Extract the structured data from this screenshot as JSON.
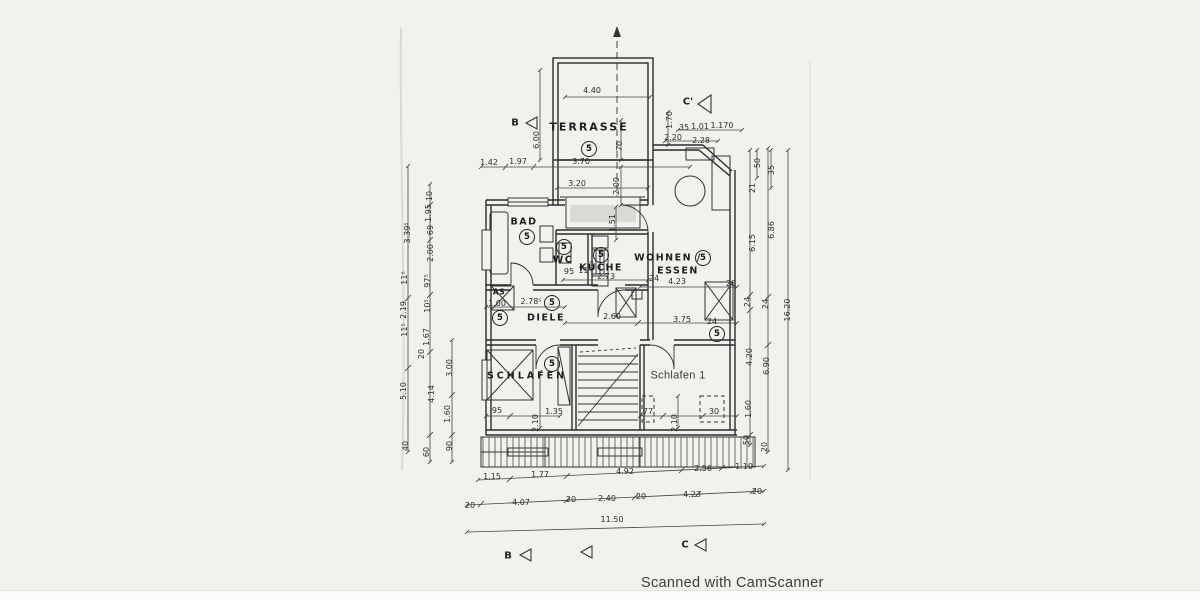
{
  "meta": {
    "watermark": "Scanned with CamScanner",
    "unit_number": "5"
  },
  "rooms": {
    "terrasse": "TERRASSE",
    "bad": "BAD",
    "wc": "WC",
    "kueche": "KÜCHE",
    "wohnen": "WOHNEN /",
    "essen": "ESSEN",
    "diele": "DIELE",
    "schlafen": "SCHLAFEN",
    "schlafen1": "Schlafen 1",
    "shaft": "AS"
  },
  "markers": {
    "b_top": "B",
    "c_prime_top": "C'",
    "b_bottom": "B",
    "c_bottom": "C"
  },
  "dim_labels": [
    {
      "t": "4.40",
      "x": 592,
      "y": 91,
      "r": 0
    },
    {
      "t": "6.00",
      "x": 537,
      "y": 140,
      "r": 1
    },
    {
      "t": "70",
      "x": 620,
      "y": 146,
      "r": 1
    },
    {
      "t": "3.70",
      "x": 581,
      "y": 162,
      "r": 0
    },
    {
      "t": "1.42",
      "x": 489,
      "y": 163,
      "r": 0
    },
    {
      "t": "1.97",
      "x": 518,
      "y": 162,
      "r": 0
    },
    {
      "t": "3.20",
      "x": 577,
      "y": 184,
      "r": 0
    },
    {
      "t": "2.00",
      "x": 617,
      "y": 186,
      "r": 1
    },
    {
      "t": "1.51",
      "x": 613,
      "y": 223,
      "r": 1
    },
    {
      "t": "1.70",
      "x": 670,
      "y": 120,
      "r": 1
    },
    {
      "t": "35",
      "x": 684,
      "y": 128,
      "r": 0
    },
    {
      "t": "1.01",
      "x": 700,
      "y": 127,
      "r": 0
    },
    {
      "t": "1.170",
      "x": 722,
      "y": 126,
      "r": 0
    },
    {
      "t": "2.20",
      "x": 673,
      "y": 138,
      "r": 0
    },
    {
      "t": "2.28",
      "x": 701,
      "y": 141,
      "r": 0
    },
    {
      "t": "50",
      "x": 758,
      "y": 163,
      "r": 1
    },
    {
      "t": "35",
      "x": 772,
      "y": 170,
      "r": 1
    },
    {
      "t": "21",
      "x": 753,
      "y": 188,
      "r": 1
    },
    {
      "t": "6.15",
      "x": 753,
      "y": 243,
      "r": 1
    },
    {
      "t": "6.86",
      "x": 772,
      "y": 230,
      "r": 1
    },
    {
      "t": "24",
      "x": 748,
      "y": 302,
      "r": 1
    },
    {
      "t": "24",
      "x": 766,
      "y": 304,
      "r": 1
    },
    {
      "t": "16.20",
      "x": 788,
      "y": 310,
      "r": 1
    },
    {
      "t": "4.20",
      "x": 750,
      "y": 357,
      "r": 1
    },
    {
      "t": "6.90",
      "x": 767,
      "y": 366,
      "r": 1
    },
    {
      "t": "1.60",
      "x": 749,
      "y": 409,
      "r": 1
    },
    {
      "t": "50",
      "x": 747,
      "y": 440,
      "r": 1
    },
    {
      "t": "20",
      "x": 765,
      "y": 447,
      "r": 1
    },
    {
      "t": "3.39⁵",
      "x": 408,
      "y": 233,
      "r": 1
    },
    {
      "t": "10",
      "x": 430,
      "y": 196,
      "r": 1
    },
    {
      "t": "1.95",
      "x": 429,
      "y": 213,
      "r": 1
    },
    {
      "t": "69",
      "x": 431,
      "y": 230,
      "r": 1
    },
    {
      "t": "2.00",
      "x": 431,
      "y": 253,
      "r": 1
    },
    {
      "t": "11⁵",
      "x": 405,
      "y": 278,
      "r": 1
    },
    {
      "t": "97⁵",
      "x": 428,
      "y": 281,
      "r": 1
    },
    {
      "t": "2.19",
      "x": 404,
      "y": 310,
      "r": 1
    },
    {
      "t": "10⁵",
      "x": 428,
      "y": 306,
      "r": 1
    },
    {
      "t": "11⁵",
      "x": 405,
      "y": 330,
      "r": 1
    },
    {
      "t": "1.67",
      "x": 427,
      "y": 337,
      "r": 1
    },
    {
      "t": "20",
      "x": 422,
      "y": 354,
      "r": 1
    },
    {
      "t": "3.00",
      "x": 450,
      "y": 368,
      "r": 1
    },
    {
      "t": "5.10",
      "x": 404,
      "y": 391,
      "r": 1
    },
    {
      "t": "4.14",
      "x": 432,
      "y": 394,
      "r": 1
    },
    {
      "t": "1.60",
      "x": 448,
      "y": 414,
      "r": 1
    },
    {
      "t": "40",
      "x": 406,
      "y": 446,
      "r": 1
    },
    {
      "t": "60",
      "x": 427,
      "y": 452,
      "r": 1
    },
    {
      "t": "90",
      "x": 450,
      "y": 446,
      "r": 1
    },
    {
      "t": "95",
      "x": 569,
      "y": 272,
      "r": 0
    },
    {
      "t": "11⁵",
      "x": 585,
      "y": 271,
      "r": 0
    },
    {
      "t": "2.73",
      "x": 606,
      "y": 277,
      "r": 0
    },
    {
      "t": "24",
      "x": 654,
      "y": 279,
      "r": 0
    },
    {
      "t": "4.23",
      "x": 677,
      "y": 282,
      "r": 0
    },
    {
      "t": "20",
      "x": 731,
      "y": 284,
      "r": 0
    },
    {
      "t": "1.00",
      "x": 497,
      "y": 304,
      "r": 0
    },
    {
      "t": "2.78⁵",
      "x": 531,
      "y": 302,
      "r": 0
    },
    {
      "t": "2.60",
      "x": 612,
      "y": 317,
      "r": 0
    },
    {
      "t": "3.75",
      "x": 682,
      "y": 320,
      "r": 0
    },
    {
      "t": "24",
      "x": 712,
      "y": 322,
      "r": 0
    },
    {
      "t": "95",
      "x": 497,
      "y": 411,
      "r": 0
    },
    {
      "t": "1.35",
      "x": 554,
      "y": 412,
      "r": 0
    },
    {
      "t": "2.10",
      "x": 536,
      "y": 423,
      "r": 1
    },
    {
      "t": "77",
      "x": 648,
      "y": 412,
      "r": 0
    },
    {
      "t": "30",
      "x": 714,
      "y": 412,
      "r": 0
    },
    {
      "t": "2.10",
      "x": 675,
      "y": 423,
      "r": 1
    },
    {
      "t": "1.15",
      "x": 492,
      "y": 477,
      "r": 0
    },
    {
      "t": "1.77",
      "x": 540,
      "y": 475,
      "r": 0
    },
    {
      "t": "4.92",
      "x": 625,
      "y": 472,
      "r": 0
    },
    {
      "t": "2.56",
      "x": 703,
      "y": 469,
      "r": 0
    },
    {
      "t": "1.10",
      "x": 744,
      "y": 467,
      "r": 0
    },
    {
      "t": "20",
      "x": 470,
      "y": 506,
      "r": 0
    },
    {
      "t": "4.07",
      "x": 521,
      "y": 503,
      "r": 0
    },
    {
      "t": "20",
      "x": 571,
      "y": 500,
      "r": 0
    },
    {
      "t": "2.40",
      "x": 607,
      "y": 499,
      "r": 0
    },
    {
      "t": "20",
      "x": 641,
      "y": 497,
      "r": 0
    },
    {
      "t": "4.23",
      "x": 692,
      "y": 495,
      "r": 0
    },
    {
      "t": "20",
      "x": 757,
      "y": 492,
      "r": 0
    },
    {
      "t": "11.50",
      "x": 612,
      "y": 520,
      "r": 0
    }
  ]
}
